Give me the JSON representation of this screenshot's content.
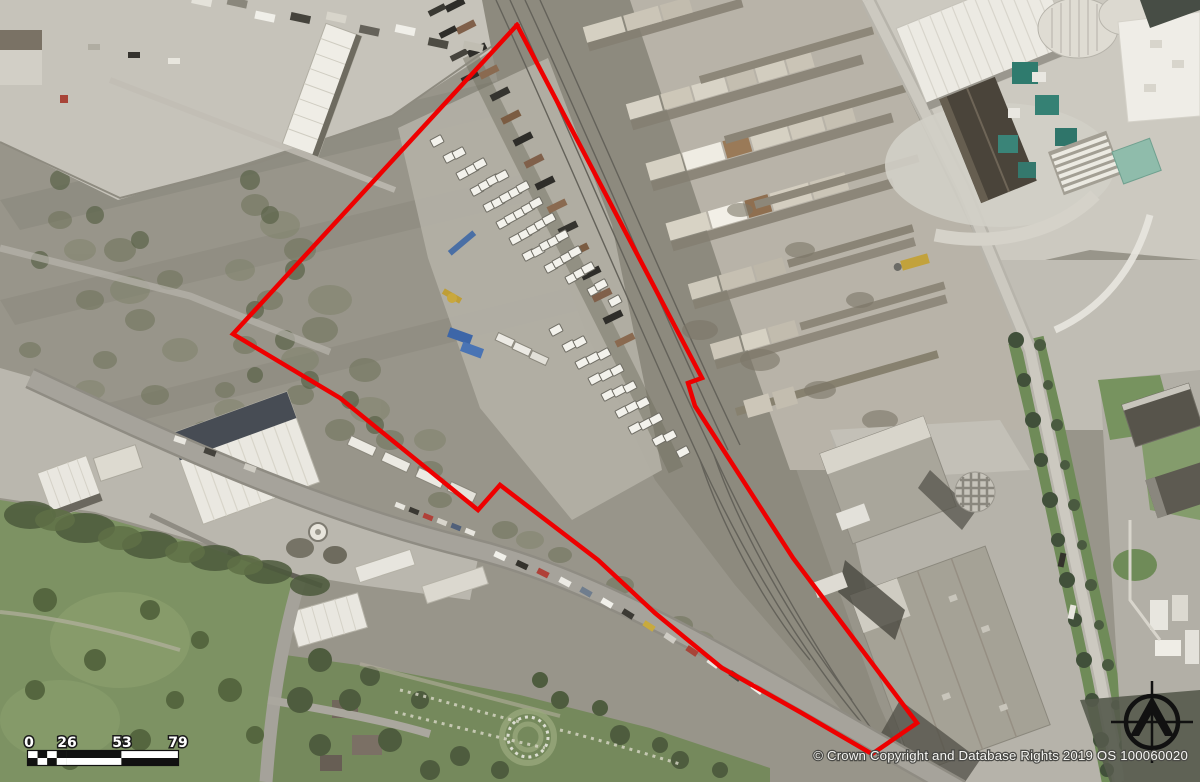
{
  "map": {
    "copyright_notice": "© Crown Copyright and Database Rights 2019 OS 100060020",
    "site_boundary": {
      "color": "#ee0000",
      "stroke_width": "4.5",
      "points": "517,25 702,378 688,383 695,406 793,558 917,723 872,754 800,712 722,668 655,613 598,560 500,485 478,510 340,398 233,334 517,25"
    },
    "scale_bar": {
      "tick_labels": [
        "0",
        "26",
        "53",
        "79"
      ]
    }
  }
}
